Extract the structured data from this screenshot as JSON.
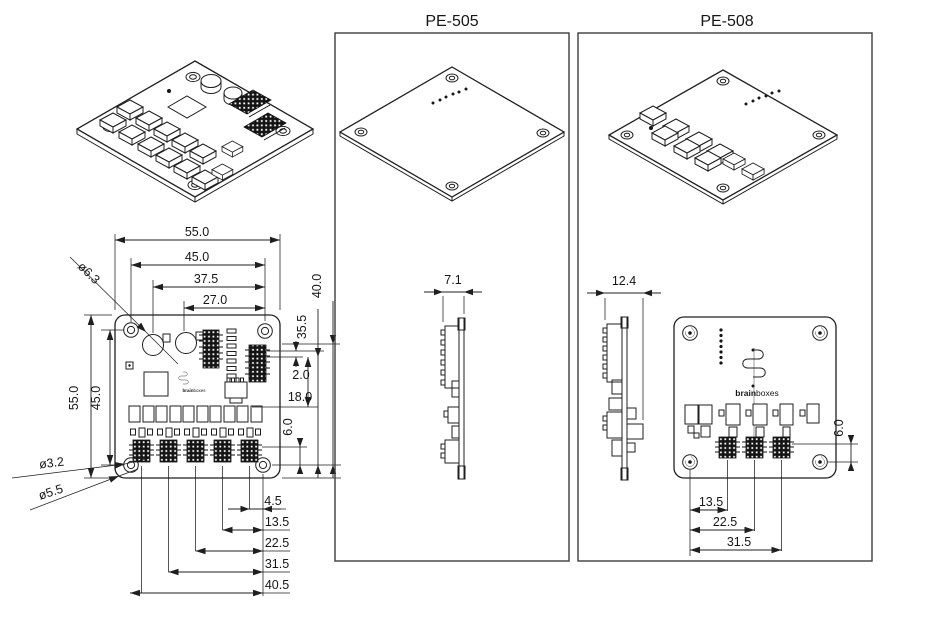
{
  "titles": {
    "pe505": "PE-505",
    "pe508": "PE-508"
  },
  "brand": {
    "bold": "brain",
    "light": "boxes"
  },
  "top_view": {
    "width_chain": [
      "55.0",
      "45.0",
      "37.5",
      "27.0"
    ],
    "height_chain": [
      "55.0",
      "45.0"
    ],
    "right_chain": {
      "board": "40.0",
      "header": "35.5",
      "gap": "2.0",
      "offset": "18.0",
      "hole": "6.0"
    },
    "bottom_chain": [
      "4.5",
      "13.5",
      "22.5",
      "31.5",
      "40.5"
    ],
    "callouts": {
      "cap": "ø6.3",
      "hole": "ø3.2",
      "pad": "ø5.5"
    }
  },
  "pe505": {
    "thickness": "7.1"
  },
  "pe508": {
    "thickness": "12.4",
    "hole_offset": "6.0",
    "bottom_chain": [
      "13.5",
      "22.5",
      "31.5"
    ]
  }
}
